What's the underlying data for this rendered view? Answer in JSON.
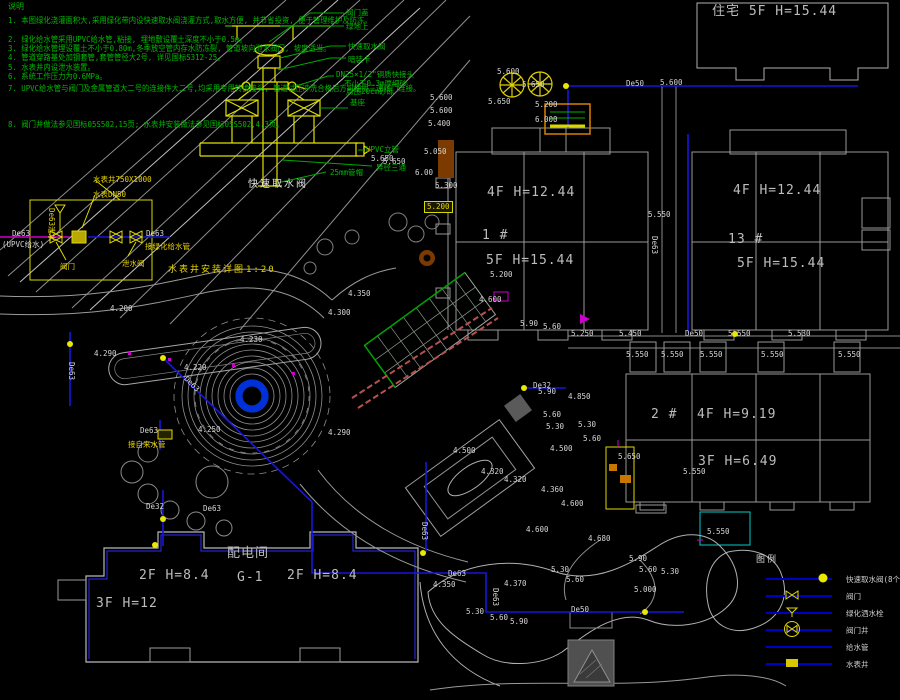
{
  "colors": {
    "background": "#000000",
    "pipe_blue": "#1616dd",
    "cad_yellow": "#e0d800",
    "cad_green": "#00b800",
    "cad_gray": "#9a9a9a",
    "magenta": "#cc00cc",
    "brown": "#7a3a00",
    "cyan": "#00cccc"
  },
  "notes": {
    "title": "说明",
    "items": [
      {
        "y": 14,
        "t": "1. 本图绿化浇灌面积大,采用绿化带内设快速取水阀浇灌方式,取水方便, 并节省投资, 便于管理维护及防冻。"
      },
      {
        "y": 33,
        "t": "2. 绿化给水管采用UPVC给水管,粘接, 埋地敷设覆土深度不小于0.5m。"
      },
      {
        "y": 42,
        "t": "3. 绿化给水管埋设覆土不小于0.80m,冬季放空管内存水防冻裂, 管道坡向泄水阀门, 坡度适当。"
      },
      {
        "y": 51,
        "t": "4. 管道穿路基处加钢套管,套管管径大2号, 详见国标S312-25。"
      },
      {
        "y": 61,
        "t": "5. 水表井内设泄水装置。"
      },
      {
        "y": 70,
        "t": "6. 系统工作压力为0.6MPa。"
      },
      {
        "y": 82,
        "t": "7. UPVC给水管与阀门及金属管道大二号的连接件大二号,均采用专用转换接头, 管道试压冲洗合格后方可使用三通阀门连接。"
      },
      {
        "y": 118,
        "t": "8. 阀门井做法参见国标05S502,15页; 水表井安装做法参见国标05S502,4.3页。"
      }
    ]
  },
  "detail": {
    "caption": "快速取水阀",
    "labels": [
      {
        "x": 346,
        "y": 9,
        "t": "阀门盖"
      },
      {
        "x": 346,
        "y": 23,
        "t": "绿地上"
      },
      {
        "x": 348,
        "y": 43,
        "t": "快速取水阀"
      },
      {
        "x": 348,
        "y": 56,
        "t": "暗装卡"
      },
      {
        "x": 336,
        "y": 71,
        "t": "DN25×1/2\"铜质快接头"
      },
      {
        "x": 344,
        "y": 80,
        "t": "不小于0.3m厚细砂"
      },
      {
        "x": 346,
        "y": 88,
        "t": "周围20cm砂砾"
      },
      {
        "x": 350,
        "y": 99,
        "t": "基座"
      },
      {
        "x": 366,
        "y": 146,
        "t": "UPVC立管"
      },
      {
        "x": 376,
        "y": 164,
        "t": "异径三通"
      },
      {
        "x": 330,
        "y": 169,
        "t": "25mm管帽"
      }
    ],
    "elev_label": {
      "x": 371,
      "y": 155,
      "t": "5.650"
    }
  },
  "meter_detail": {
    "caption": "水表井安装详图",
    "scale": "1:20",
    "labels_yellow": [
      {
        "x": 93,
        "y": 176,
        "t": "水表井750X1000"
      },
      {
        "x": 93,
        "y": 191,
        "t": "水表DN50"
      },
      {
        "x": 55,
        "y": 208,
        "t": "De63泄水",
        "rot": 90
      },
      {
        "x": 60,
        "y": 263,
        "t": "阀门"
      },
      {
        "x": 145,
        "y": 243,
        "t": "接绿化给水管"
      },
      {
        "x": 122,
        "y": 260,
        "t": "泄水阀"
      }
    ],
    "labels_white": [
      {
        "x": 12,
        "y": 230,
        "t": "De63"
      },
      {
        "x": 2,
        "y": 241,
        "t": "(UPVC给水)"
      },
      {
        "x": 146,
        "y": 230,
        "t": "De63"
      }
    ]
  },
  "plan": {
    "building_labels": [
      {
        "x": 712,
        "y": 5,
        "t": "住宅  5F H=15.44"
      },
      {
        "x": 487,
        "y": 186,
        "t": "4F H=12.44"
      },
      {
        "x": 482,
        "y": 229,
        "t": "1 #"
      },
      {
        "x": 486,
        "y": 254,
        "t": "5F H=15.44"
      },
      {
        "x": 733,
        "y": 184,
        "t": "4F H=12.44"
      },
      {
        "x": 728,
        "y": 233,
        "t": "13 #"
      },
      {
        "x": 737,
        "y": 257,
        "t": "5F H=15.44"
      },
      {
        "x": 651,
        "y": 408,
        "t": "2 #"
      },
      {
        "x": 697,
        "y": 408,
        "t": "4F H=9.19"
      },
      {
        "x": 698,
        "y": 455,
        "t": "3F H=6.49"
      },
      {
        "x": 139,
        "y": 569,
        "t": "2F H=8.4"
      },
      {
        "x": 227,
        "y": 547,
        "t": "配电间"
      },
      {
        "x": 237,
        "y": 571,
        "t": "G-1"
      },
      {
        "x": 287,
        "y": 569,
        "t": "2F H=8.4"
      },
      {
        "x": 96,
        "y": 597,
        "t": "3F H=12"
      }
    ],
    "elevations": [
      {
        "x": 497,
        "y": 68,
        "t": "5.600"
      },
      {
        "x": 522,
        "y": 81,
        "t": "5.650"
      },
      {
        "x": 488,
        "y": 98,
        "t": "5.650"
      },
      {
        "x": 535,
        "y": 101,
        "t": "5.200"
      },
      {
        "x": 535,
        "y": 116,
        "t": "6.000"
      },
      {
        "x": 660,
        "y": 79,
        "t": "5.600"
      },
      {
        "x": 430,
        "y": 94,
        "t": "5.600"
      },
      {
        "x": 430,
        "y": 107,
        "t": "5.600"
      },
      {
        "x": 428,
        "y": 120,
        "t": "5.400"
      },
      {
        "x": 424,
        "y": 148,
        "t": "5.050"
      },
      {
        "x": 383,
        "y": 158,
        "t": "5.650"
      },
      {
        "x": 415,
        "y": 169,
        "t": "6.00"
      },
      {
        "x": 435,
        "y": 182,
        "t": "5.300"
      },
      {
        "x": 490,
        "y": 271,
        "t": "5.200"
      },
      {
        "x": 648,
        "y": 211,
        "t": "5.550"
      },
      {
        "x": 619,
        "y": 330,
        "t": "5.450"
      },
      {
        "x": 571,
        "y": 330,
        "t": "5.250"
      },
      {
        "x": 728,
        "y": 330,
        "t": "5.550"
      },
      {
        "x": 788,
        "y": 330,
        "t": "5.530"
      },
      {
        "x": 626,
        "y": 351,
        "t": "5.550"
      },
      {
        "x": 661,
        "y": 351,
        "t": "5.550"
      },
      {
        "x": 700,
        "y": 351,
        "t": "5.550"
      },
      {
        "x": 761,
        "y": 351,
        "t": "5.550"
      },
      {
        "x": 838,
        "y": 351,
        "t": "5.550"
      },
      {
        "x": 520,
        "y": 320,
        "t": "5.90"
      },
      {
        "x": 543,
        "y": 323,
        "t": "5.60"
      },
      {
        "x": 538,
        "y": 388,
        "t": "5.90"
      },
      {
        "x": 568,
        "y": 393,
        "t": "4.850"
      },
      {
        "x": 543,
        "y": 411,
        "t": "5.60"
      },
      {
        "x": 546,
        "y": 423,
        "t": "5.30"
      },
      {
        "x": 578,
        "y": 421,
        "t": "5.30"
      },
      {
        "x": 583,
        "y": 435,
        "t": "5.60"
      },
      {
        "x": 550,
        "y": 445,
        "t": "4.500"
      },
      {
        "x": 618,
        "y": 453,
        "t": "5.650"
      },
      {
        "x": 683,
        "y": 468,
        "t": "5.550"
      },
      {
        "x": 707,
        "y": 528,
        "t": "5.550"
      },
      {
        "x": 453,
        "y": 447,
        "t": "4.500"
      },
      {
        "x": 481,
        "y": 468,
        "t": "4.320"
      },
      {
        "x": 504,
        "y": 476,
        "t": "4.320"
      },
      {
        "x": 541,
        "y": 486,
        "t": "4.360"
      },
      {
        "x": 561,
        "y": 500,
        "t": "4.600"
      },
      {
        "x": 526,
        "y": 526,
        "t": "4.600"
      },
      {
        "x": 588,
        "y": 535,
        "t": "4.680"
      },
      {
        "x": 629,
        "y": 555,
        "t": "5.90"
      },
      {
        "x": 639,
        "y": 566,
        "t": "5.60"
      },
      {
        "x": 661,
        "y": 568,
        "t": "5.30"
      },
      {
        "x": 551,
        "y": 566,
        "t": "5.30"
      },
      {
        "x": 566,
        "y": 576,
        "t": "5.60"
      },
      {
        "x": 634,
        "y": 586,
        "t": "5.000"
      },
      {
        "x": 433,
        "y": 581,
        "t": "4.350"
      },
      {
        "x": 504,
        "y": 580,
        "t": "4.370"
      },
      {
        "x": 466,
        "y": 608,
        "t": "5.30"
      },
      {
        "x": 490,
        "y": 614,
        "t": "5.60"
      },
      {
        "x": 510,
        "y": 618,
        "t": "5.90"
      },
      {
        "x": 110,
        "y": 305,
        "t": "4.200"
      },
      {
        "x": 94,
        "y": 350,
        "t": "4.290"
      },
      {
        "x": 184,
        "y": 364,
        "t": "4.220"
      },
      {
        "x": 240,
        "y": 336,
        "t": "4.230"
      },
      {
        "x": 198,
        "y": 426,
        "t": "4.250"
      },
      {
        "x": 328,
        "y": 429,
        "t": "4.290"
      },
      {
        "x": 348,
        "y": 290,
        "t": "4.350"
      },
      {
        "x": 328,
        "y": 309,
        "t": "4.300"
      },
      {
        "x": 479,
        "y": 296,
        "t": "4.600"
      }
    ],
    "pipe_labels": [
      {
        "x": 626,
        "y": 80,
        "t": "De50"
      },
      {
        "x": 685,
        "y": 330,
        "t": "De50"
      },
      {
        "x": 658,
        "y": 236,
        "t": "De63",
        "rot": 90
      },
      {
        "x": 448,
        "y": 570,
        "t": "De63"
      },
      {
        "x": 499,
        "y": 588,
        "t": "De63",
        "rot": 90
      },
      {
        "x": 428,
        "y": 522,
        "t": "De63",
        "rot": 90
      },
      {
        "x": 571,
        "y": 606,
        "t": "De50"
      },
      {
        "x": 140,
        "y": 427,
        "t": "De63"
      },
      {
        "x": 146,
        "y": 503,
        "t": "De32"
      },
      {
        "x": 203,
        "y": 505,
        "t": "De63"
      },
      {
        "x": 75,
        "y": 362,
        "t": "De63",
        "rot": 90
      },
      {
        "x": 533,
        "y": 382,
        "t": "De32"
      },
      {
        "x": 188,
        "y": 375,
        "t": "De63",
        "rot": 45
      }
    ],
    "yellow_labels": [
      {
        "x": 128,
        "y": 441,
        "t": "接自来水管"
      }
    ],
    "boxed_label": {
      "x": 424,
      "y": 201,
      "t": "5.200"
    }
  },
  "legend": {
    "title": "图例",
    "items": [
      {
        "symbol": "quick-intake-valve",
        "label": "快速取水阀(8个)"
      },
      {
        "symbol": "valve",
        "label": "阀门"
      },
      {
        "symbol": "sprinkler",
        "label": "绿化洒水栓"
      },
      {
        "symbol": "valve-well",
        "label": "阀门井"
      },
      {
        "symbol": "water-pipe",
        "label": "给水管"
      },
      {
        "symbol": "meter-well",
        "label": "水表井"
      }
    ]
  }
}
